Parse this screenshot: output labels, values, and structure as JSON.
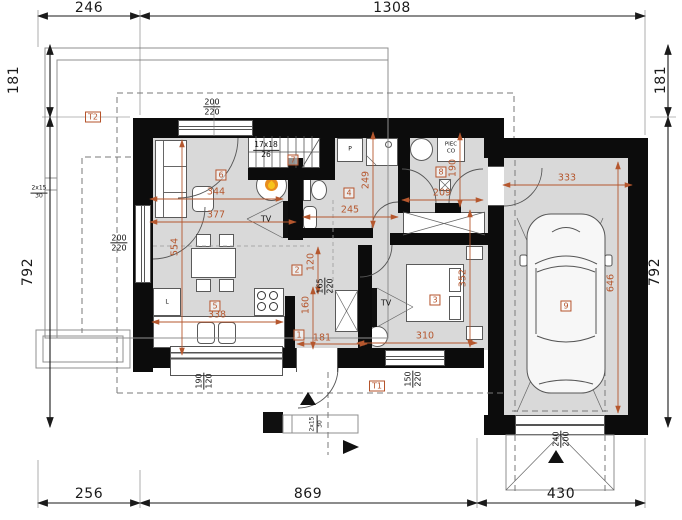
{
  "exterior_dims": {
    "top": [
      "246",
      "1308"
    ],
    "left": [
      "181",
      "792"
    ],
    "right": [
      "181",
      "792"
    ],
    "bottom": [
      "256",
      "869",
      "430"
    ]
  },
  "room_labels": {
    "entry": "1",
    "hall": "2",
    "bedroom": "3",
    "bath": "4",
    "kitchen": "5",
    "living": "6",
    "stairs": "7",
    "boiler": "8",
    "garage": "9",
    "porch": "T1",
    "terrace": "T2"
  },
  "interior_dims": {
    "living_width_a": "344",
    "living_width_b": "377",
    "living_height": "554",
    "kitchen_width": "338",
    "hall_width": "120",
    "entry_height": "160",
    "entry_width": "181",
    "bath_width": "245",
    "bath_height": "249",
    "boiler_width": "209",
    "boiler_height": "190",
    "bedroom_width": "310",
    "bedroom_height": "352",
    "garage_width": "333",
    "garage_depth": "646"
  },
  "openings": {
    "balcony_door_top": {
      "w": "200",
      "h": "220"
    },
    "terrace_door_left": {
      "w": "200",
      "h": "220"
    },
    "kitchen_window": {
      "w": "190",
      "h": "120"
    },
    "entry_door": {
      "w": "165",
      "h": "220"
    },
    "front_window": {
      "w": "150",
      "h": "220"
    },
    "garage_door": {
      "w": "240",
      "h": "200"
    }
  },
  "stairs": {
    "flight": "17x18",
    "tread": "26"
  },
  "exterior_steps": {
    "count": "2x15",
    "tread": "30"
  },
  "equipment": {
    "tv": "TV",
    "boiler_line1": "PIEC",
    "boiler_line2": "CO",
    "washing_machine": "P",
    "fridge": "L"
  }
}
